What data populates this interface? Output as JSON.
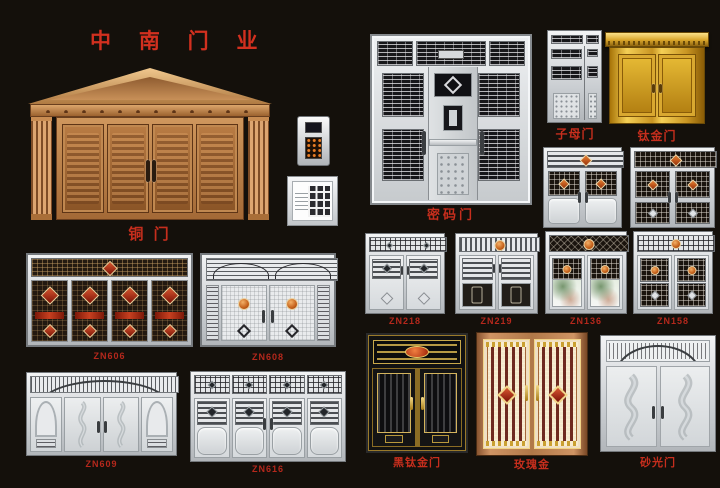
{
  "poster": {
    "title": "中 南 门 业"
  },
  "products": {
    "copper": {
      "label": "铜 门"
    },
    "password": {
      "label": "密码门"
    },
    "mother_son": {
      "label": "子母门"
    },
    "titanium_gold": {
      "label": "钛金门"
    },
    "zn606": {
      "label": "ZN606"
    },
    "zn608": {
      "label": "ZN608"
    },
    "zn218": {
      "label": "ZN218"
    },
    "zn219": {
      "label": "ZN219"
    },
    "zn136": {
      "label": "ZN136"
    },
    "zn158": {
      "label": "ZN158"
    },
    "zn609": {
      "label": "ZN609"
    },
    "zn616": {
      "label": "ZN616"
    },
    "black_titanium": {
      "label": "黑钛金门"
    },
    "rose_gold": {
      "label": "玫瑰金"
    },
    "sand_polish": {
      "label": "砂光门"
    }
  },
  "colors": {
    "background": "#14100b",
    "title_red": "#d2301f",
    "label_red": "#bf2a1a",
    "copper": "#c08850",
    "titanium_gold": "#e0ae2c",
    "stainless": "#d6d9dc",
    "medallion_orange": "#d97b2a",
    "accent_red": "#b02c14"
  }
}
